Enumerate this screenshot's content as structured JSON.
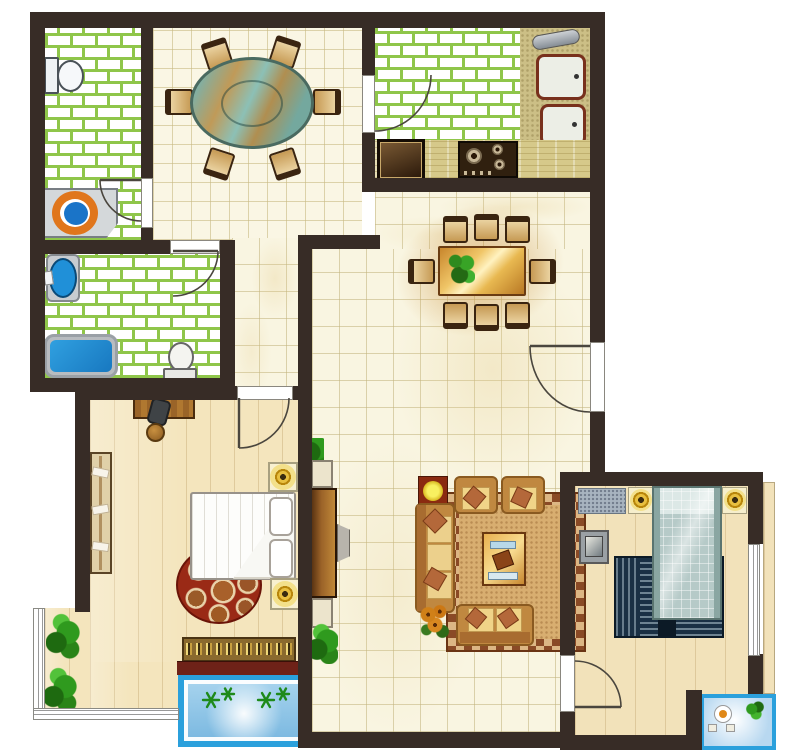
{
  "type": "apartment-floor-plan",
  "title": "Two-bedroom apartment floor plan (top view)",
  "palette": {
    "wall": "#372c26",
    "brick_tile_line": "#8fc64a",
    "cream_tile": "#f9f5e1",
    "wood_floor": "#f4e5bd",
    "water_blue": "#1b8fd4",
    "balcony_blue": "#2ba0dc",
    "sofa_tan": "#c08840",
    "cushion": "#f0d488",
    "pillow_rust": "#b4683a",
    "rug_border_brown": "#8a4a26",
    "rug_field": "#d8ae70",
    "table_wood": "#e8b850",
    "dining_table_teal": "#7fb0a6",
    "lamp_gold": "#b8860b",
    "plant_green": "#2f9a1e",
    "fixture_orange": "#e0761c",
    "bed2_fabric": "#b6cac8",
    "rug2_navy": "#1a3044"
  },
  "rooms": [
    {
      "id": "bathroom-1",
      "label": "Bathroom 1 (top-left)",
      "floor": "green-brick-tile",
      "furniture": [
        "toilet",
        "round washbasin with orange rim and blue bowl"
      ]
    },
    {
      "id": "dining-room",
      "label": "Dining room",
      "floor": "cream-tile",
      "furniture": [
        "oval teal glass dining table",
        "6 wooden chairs"
      ]
    },
    {
      "id": "kitchen",
      "label": "Kitchen",
      "floor": "green-brick-tile",
      "furniture": [
        "double-basin sink with faucet",
        "L-counter",
        "4-burner gas stove",
        "oven unit"
      ]
    },
    {
      "id": "living-hall",
      "label": "Living / dining hall",
      "floor": "cream-tile",
      "furniture": [
        "rectangular 8-seat dining table with plant",
        "upright piano with bench",
        "two storage cabinets",
        "three-seat sofa",
        "2 armchairs",
        "loveseat",
        "wooden coffee table with tea set",
        "area rug with greek-key border",
        "red side table with yellow lamp",
        "sunflower pot",
        "2 potted plants"
      ]
    },
    {
      "id": "bathroom-2",
      "label": "Bathroom 2 (middle-left)",
      "floor": "green-brick-tile",
      "furniture": [
        "oval blue washbasin",
        "blue bathtub",
        "toilet"
      ]
    },
    {
      "id": "master-bedroom",
      "label": "Master bedroom (bottom-left)",
      "floor": "wood",
      "furniture": [
        "desk",
        "office chair",
        "round stool",
        "wardrobe with hanging clothes",
        "double bed with folded duvet",
        "2 nightstands with gold lamps",
        "round animal-print rug",
        "patterned radiator bench"
      ]
    },
    {
      "id": "bedroom-2",
      "label": "Bedroom 2 (bottom-right)",
      "floor": "wood",
      "furniture": [
        "double bed with quilted blue bedding",
        "2 nightstands with gold lamps",
        "speckled dresser",
        "tv stand",
        "navy striped rug"
      ]
    },
    {
      "id": "balcony-west",
      "label": "West bay balcony",
      "floor": "wood",
      "furniture": [
        "2 green shrubs"
      ]
    },
    {
      "id": "flower-box-south",
      "label": "South blue flower box",
      "furniture": [
        "4 palm-star plants"
      ]
    },
    {
      "id": "balcony-southeast",
      "label": "South-east blue balcony",
      "furniture": [
        "bistro table",
        "2 seats",
        "plant"
      ]
    }
  ],
  "doors": [
    {
      "room": "bathroom-1",
      "wall": "east",
      "swing": "inward"
    },
    {
      "room": "bathroom-2",
      "wall": "north",
      "swing": "inward"
    },
    {
      "room": "kitchen",
      "wall": "west",
      "swing": "inward"
    },
    {
      "room": "master-bedroom",
      "wall": "north",
      "swing": "inward"
    },
    {
      "room": "bedroom-2",
      "wall": "west",
      "swing": "inward"
    },
    {
      "room": "apartment-entry",
      "wall": "east",
      "swing": "inward"
    }
  ],
  "windows": [
    {
      "room": "balcony-west",
      "wall": "west+south",
      "style": "triple-line frame"
    },
    {
      "room": "bedroom-2",
      "wall": "east",
      "style": "triple-line frame"
    }
  ]
}
